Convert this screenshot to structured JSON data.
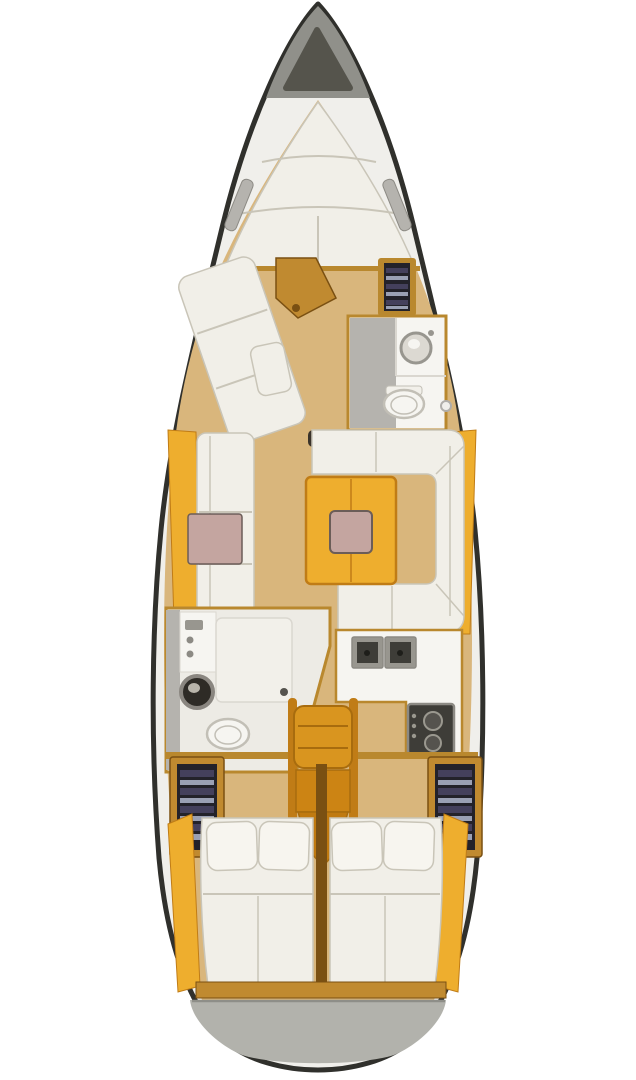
{
  "meta": {
    "title": "Sailboat interior deck layout plan (top-down view)",
    "canvas": {
      "width": 636,
      "height": 1080
    }
  },
  "palette": {
    "background": "#ffffff",
    "hull_outline": "#30302c",
    "deck_white": "#f0efeb",
    "bow_gray": "#90908a",
    "anchor_locker": "#55544c",
    "transom_gray": "#b2b2ac",
    "transom_edge": "#8e8e88",
    "wood_floor": "#d9b67c",
    "wood_trim": "#b9882e",
    "wood_mid": "#c08a30",
    "wood_dark": "#7a5012",
    "accent_orange": "#eeae2e",
    "accent_orange_dark": "#c07c16",
    "step_orange": "#d9951f",
    "step_mid": "#cc8414",
    "step_low": "#c07a10",
    "step_edge": "#a86c0e",
    "cushion_white": "#f1efe8",
    "pillow_white": "#f7f5ef",
    "cushion_seam": "#c9c5b8",
    "table_pink": "#c4a5a0",
    "pink_border": "#6b5d58",
    "counter_white": "#f6f5f1",
    "panel_white": "#f2f0ea",
    "head_floor": "#edebe5",
    "seam_light": "#dad7d0",
    "appliance_gray": "#98968f",
    "appliance_dark": "#3e3d38",
    "appliance_edge": "#8c8a84",
    "burner_gray": "#55534e",
    "knob_gray": "#9a988f",
    "drain_dark": "#1e1e1a",
    "shower_gray": "#b5b3ae",
    "sink_dark": "#2e2b26",
    "sink_ring": "#8a8680",
    "sink_highlight": "#b8b4aa",
    "basin_gray": "#dcd9d2",
    "locker_dark": "#23222a",
    "locker_stripe_a": "#44405c",
    "locker_stripe_b": "#9aa0b4",
    "mast_step": "#3a332a",
    "toilet_stroke": "#c2bfb6",
    "porthole_ring": "#b0aeaa"
  },
  "regions": [
    {
      "id": "anchor-locker",
      "label": "Anchor locker (bow)"
    },
    {
      "id": "v-berth",
      "label": "Forward V-berth mattress"
    },
    {
      "id": "forward-sofa",
      "label": "Forward cabin angled berth / sofa"
    },
    {
      "id": "forward-head",
      "label": "Forward head with sink and toilet"
    },
    {
      "id": "port-settee",
      "label": "Port straight settee with small table"
    },
    {
      "id": "salon-table",
      "label": "Salon table with centerpiece"
    },
    {
      "id": "starboard-settee",
      "label": "Starboard U-shaped settee"
    },
    {
      "id": "galley",
      "label": "Galley with twin sinks and stove"
    },
    {
      "id": "aft-head",
      "label": "Aft head with sink, toilet and shower"
    },
    {
      "id": "companionway-steps",
      "label": "Companionway steps"
    },
    {
      "id": "aft-cabin-port",
      "label": "Port aft double berth"
    },
    {
      "id": "aft-cabin-starboard",
      "label": "Starboard aft double berth"
    },
    {
      "id": "transom",
      "label": "Stern transom / swim platform"
    }
  ]
}
